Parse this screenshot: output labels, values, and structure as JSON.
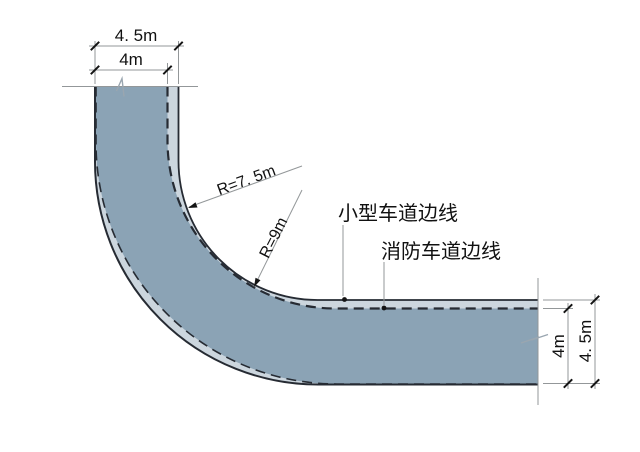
{
  "scene": {
    "kind": "fire-lane-corner-turning-radius-diagram"
  },
  "colors": {
    "car_lane_fill": "#ccd6de",
    "fire_lane_fill": "#8ba3b5",
    "edge_line": "#262b33",
    "construction_line": "#939799",
    "text": "#111111"
  },
  "dimensions": {
    "top_outer": "4. 5m",
    "top_inner": "4m",
    "right_inner": "4m",
    "right_outer": "4. 5m"
  },
  "radii": {
    "car_lane_inner": "R=7. 5m",
    "fire_lane_inner": "R=9m"
  },
  "callouts": {
    "car_lane_edge": "小型车道边线",
    "fire_lane_edge": "消防车道边线"
  }
}
